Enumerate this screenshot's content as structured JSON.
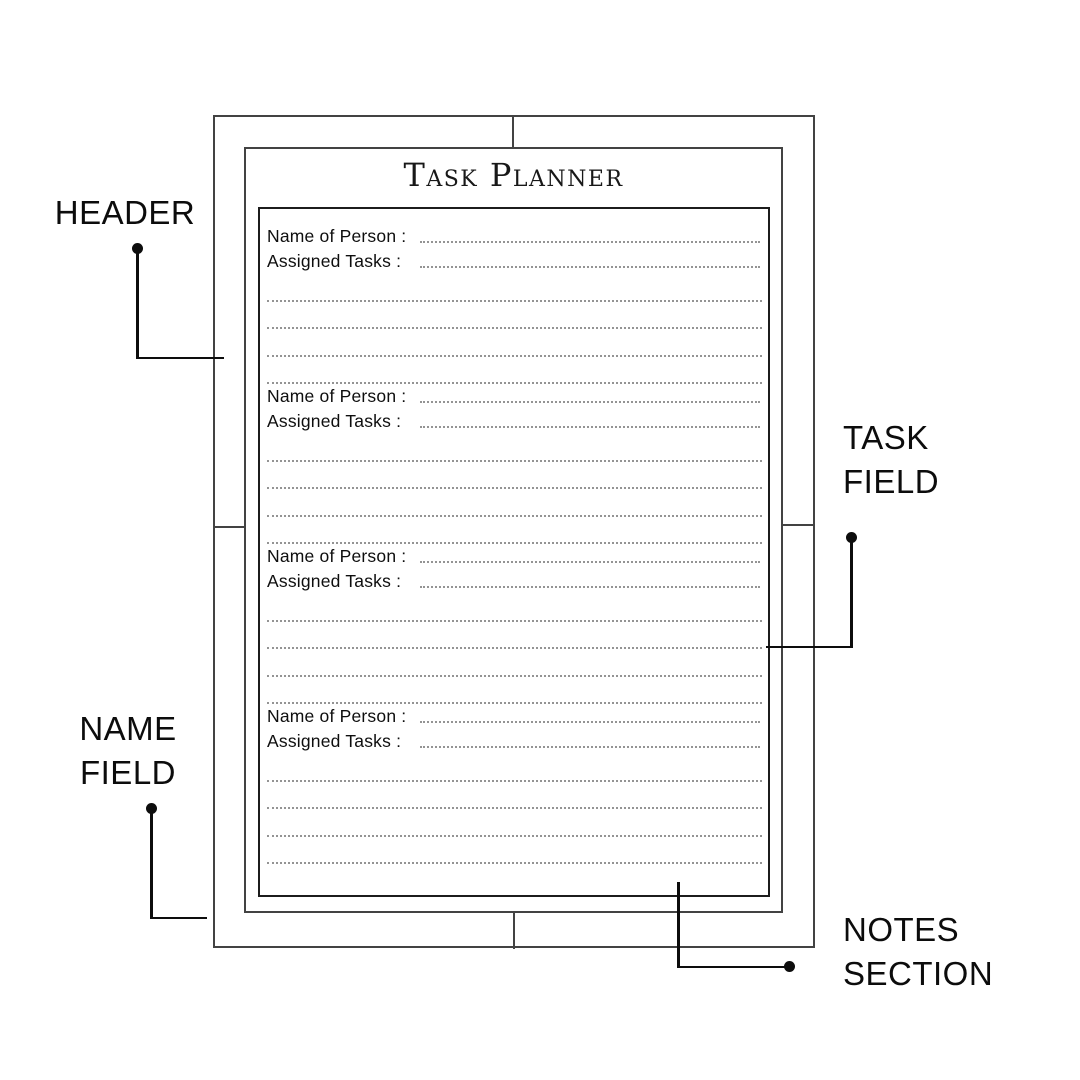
{
  "planner": {
    "title": "Task Planner",
    "sections": [
      {
        "name_label": "Name of Person :",
        "tasks_label": "Assigned Tasks :"
      },
      {
        "name_label": "Name of Person :",
        "tasks_label": "Assigned Tasks :"
      },
      {
        "name_label": "Name of Person :",
        "tasks_label": "Assigned Tasks :"
      },
      {
        "name_label": "Name of Person :",
        "tasks_label": "Assigned Tasks :"
      }
    ]
  },
  "annotations": {
    "header": {
      "label": "HEADER"
    },
    "task_field": {
      "line1": "TASK",
      "line2": "FIELD"
    },
    "name_field": {
      "line1": "NAME",
      "line2": "FIELD"
    },
    "notes_section": {
      "line1": "NOTES",
      "line2": "SECTION"
    }
  },
  "colors": {
    "ink": "#0c0c0c",
    "frame_border": "#434343",
    "content_border": "#1c1c1c",
    "dotted_line": "#949494",
    "background": "#ffffff"
  }
}
